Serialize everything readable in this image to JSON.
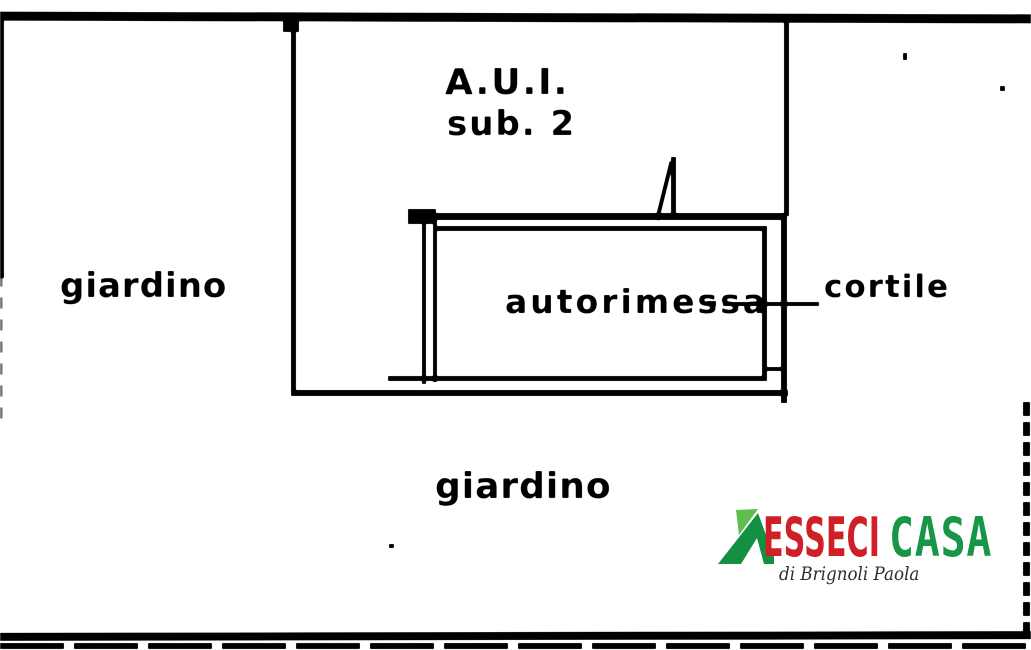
{
  "plan": {
    "unit_label_line1": "A.U.I.",
    "unit_label_line2": "sub. 2",
    "areas": {
      "garden_left": "giardino",
      "garage": "autorimessa",
      "courtyard": "cortile",
      "garden_bottom": "giardino"
    }
  },
  "logo": {
    "brand_primary": "ESSECI",
    "brand_secondary": "CASA",
    "tagline": "di Brignoli Paola",
    "icon": "house-roof-icon",
    "colors": {
      "brand_red": "#cf2027",
      "brand_green": "#189648",
      "roof_dark_green": "#139042",
      "roof_light_green": "#5dbd4d"
    }
  },
  "colors": {
    "ink": "#0d0d0d",
    "background": "#ffffff"
  }
}
